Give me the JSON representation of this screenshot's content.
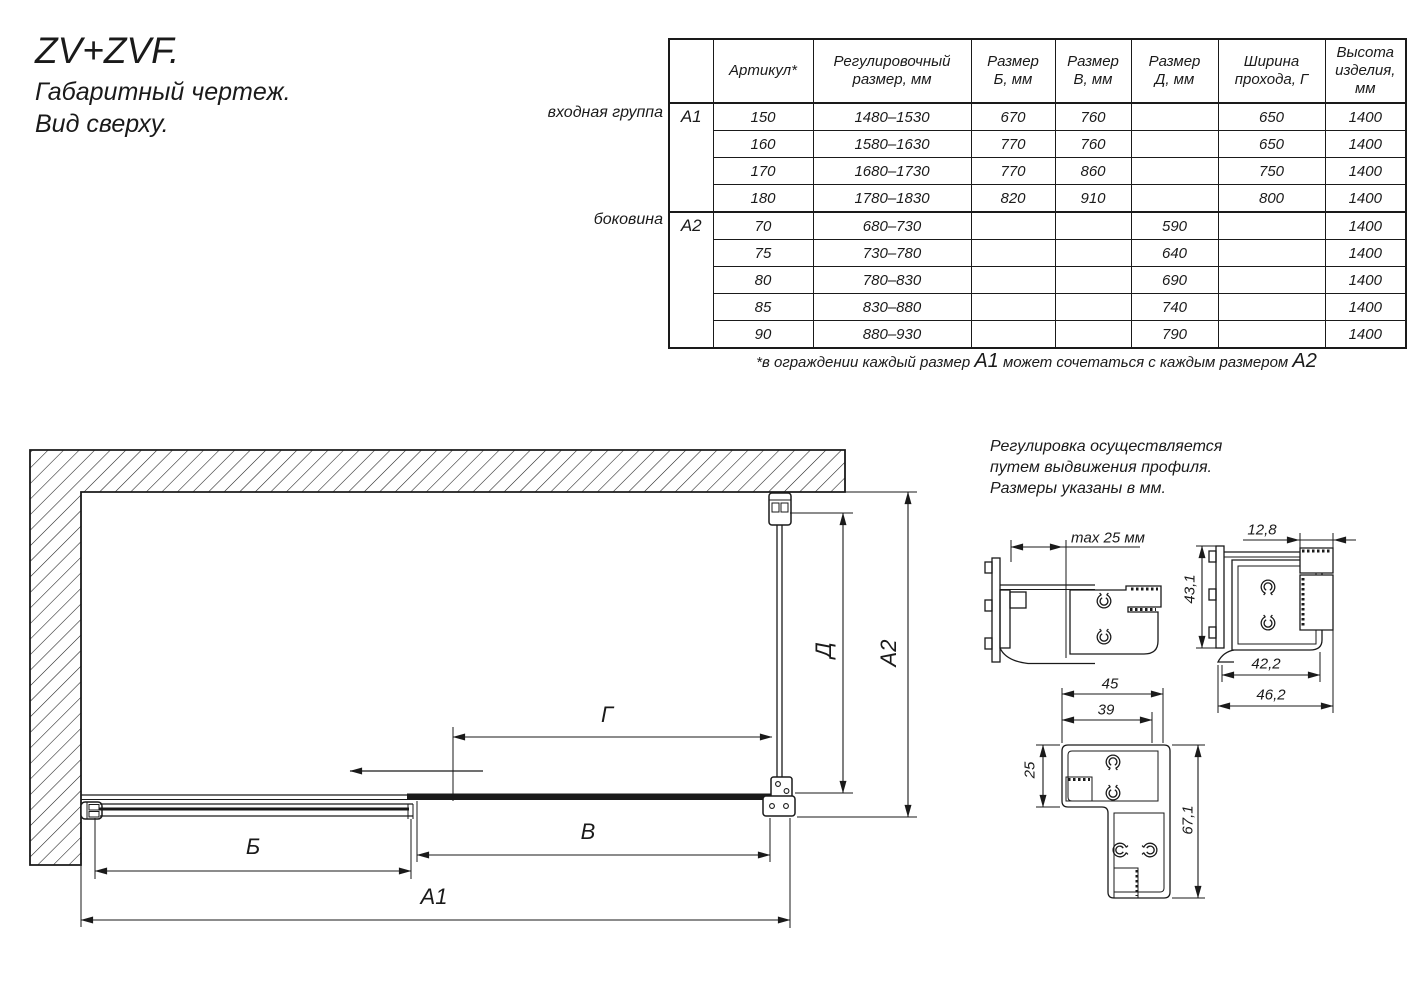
{
  "title": {
    "line1": "ZV+ZVF.",
    "line2": "Габаритный чертеж.",
    "line3": "Вид сверху."
  },
  "table": {
    "headers": [
      "",
      "Артикул*",
      "Регулировочный\nразмер, мм",
      "Размер\nБ, мм",
      "Размер\nВ, мм",
      "Размер\nД, мм",
      "Ширина\nпрохода, Г",
      "Высота\nизделия,\nмм"
    ],
    "groups": [
      {
        "id": "А1",
        "label": "входная группа",
        "rows": [
          [
            "150",
            "1480–1530",
            "670",
            "760",
            "",
            "650",
            "1400"
          ],
          [
            "160",
            "1580–1630",
            "770",
            "760",
            "",
            "650",
            "1400"
          ],
          [
            "170",
            "1680–1730",
            "770",
            "860",
            "",
            "750",
            "1400"
          ],
          [
            "180",
            "1780–1830",
            "820",
            "910",
            "",
            "800",
            "1400"
          ]
        ]
      },
      {
        "id": "А2",
        "label": "боковина",
        "rows": [
          [
            "70",
            "680–730",
            "",
            "",
            "590",
            "",
            "1400"
          ],
          [
            "75",
            "730–780",
            "",
            "",
            "640",
            "",
            "1400"
          ],
          [
            "80",
            "780–830",
            "",
            "",
            "690",
            "",
            "1400"
          ],
          [
            "85",
            "830–880",
            "",
            "",
            "740",
            "",
            "1400"
          ],
          [
            "90",
            "880–930",
            "",
            "",
            "790",
            "",
            "1400"
          ]
        ]
      }
    ],
    "footnote": {
      "pre": "*в ограждении каждый размер ",
      "a1": "А1",
      "mid": " может сочетаться с каждым размером ",
      "a2": "А2"
    }
  },
  "note": {
    "line1": "Регулировка осуществляется",
    "line2": "путем выдвижения профиля.",
    "line3": "Размеры указаны в мм."
  },
  "plan_labels": {
    "b": "Б",
    "v": "В",
    "a1": "А1",
    "g": "Г",
    "d": "Д",
    "a2": "А2"
  },
  "profile_dims": {
    "max25": "max 25 мм",
    "d128": "12,8",
    "d431": "43,1",
    "d422": "42,2",
    "d462": "46,2",
    "d45": "45",
    "d39": "39",
    "d25": "25",
    "d671": "67,1"
  },
  "colors": {
    "ink": "#1a1a1a",
    "background": "#ffffff"
  }
}
